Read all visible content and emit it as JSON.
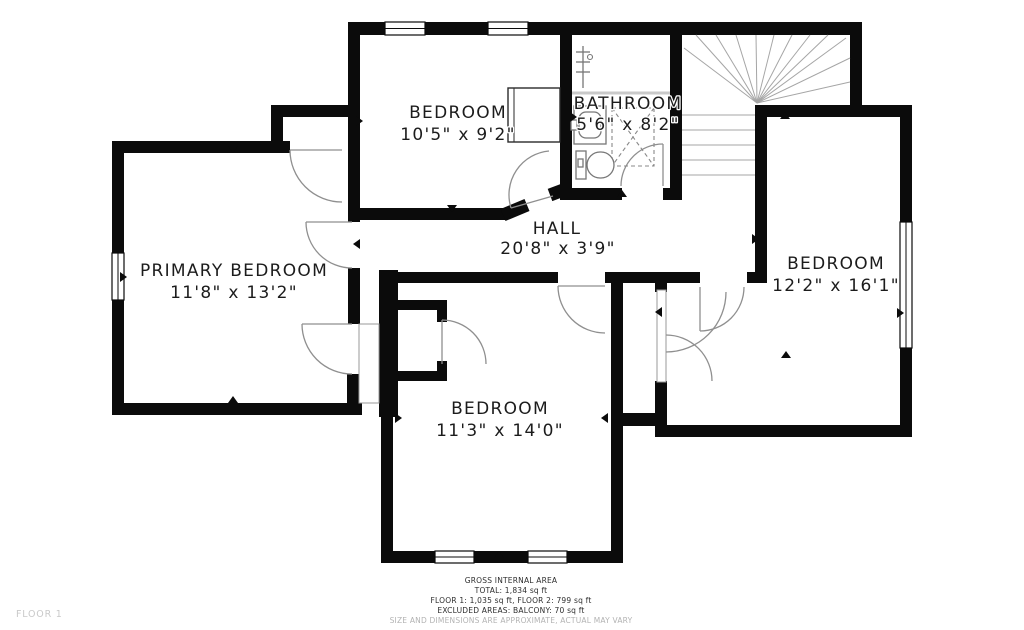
{
  "floor_label": "FLOOR 1",
  "rooms": {
    "bedroom_top": {
      "name": "BEDROOM",
      "dims": "10'5\" x 9'2\""
    },
    "bathroom": {
      "name": "BATHROOM",
      "dims": "5'6\" x 8'2\""
    },
    "primary_bedroom": {
      "name": "PRIMARY BEDROOM",
      "dims": "11'8\" x 13'2\""
    },
    "hall": {
      "name": "HALL",
      "dims": "20'8\" x 3'9\""
    },
    "bedroom_right": {
      "name": "BEDROOM",
      "dims": "12'2\" x 16'1\""
    },
    "bedroom_bottom": {
      "name": "BEDROOM",
      "dims": "11'3\" x 14'0\""
    }
  },
  "footer": {
    "title": "GROSS INTERNAL AREA",
    "total": "TOTAL: 1,834 sq ft",
    "floors": "FLOOR 1: 1,035 sq ft, FLOOR 2: 799 sq ft",
    "excluded": "EXCLUDED AREAS: BALCONY: 70 sq ft",
    "disclaimer": "SIZE AND DIMENSIONS ARE APPROXIMATE, ACTUAL MAY VARY"
  },
  "symbols": {
    "toilet": "toilet-symbol",
    "shower": "shower-symbol",
    "sink": "sink-vanity-symbol",
    "towel_rail": "towel-rail-symbol",
    "wardrobe": "wardrobe-symbol",
    "stairs": "staircase-symbol"
  },
  "colors": {
    "wall": "#0b0b0b",
    "door_line": "#8f8f8f",
    "muted_text": "#b3b3b3"
  }
}
